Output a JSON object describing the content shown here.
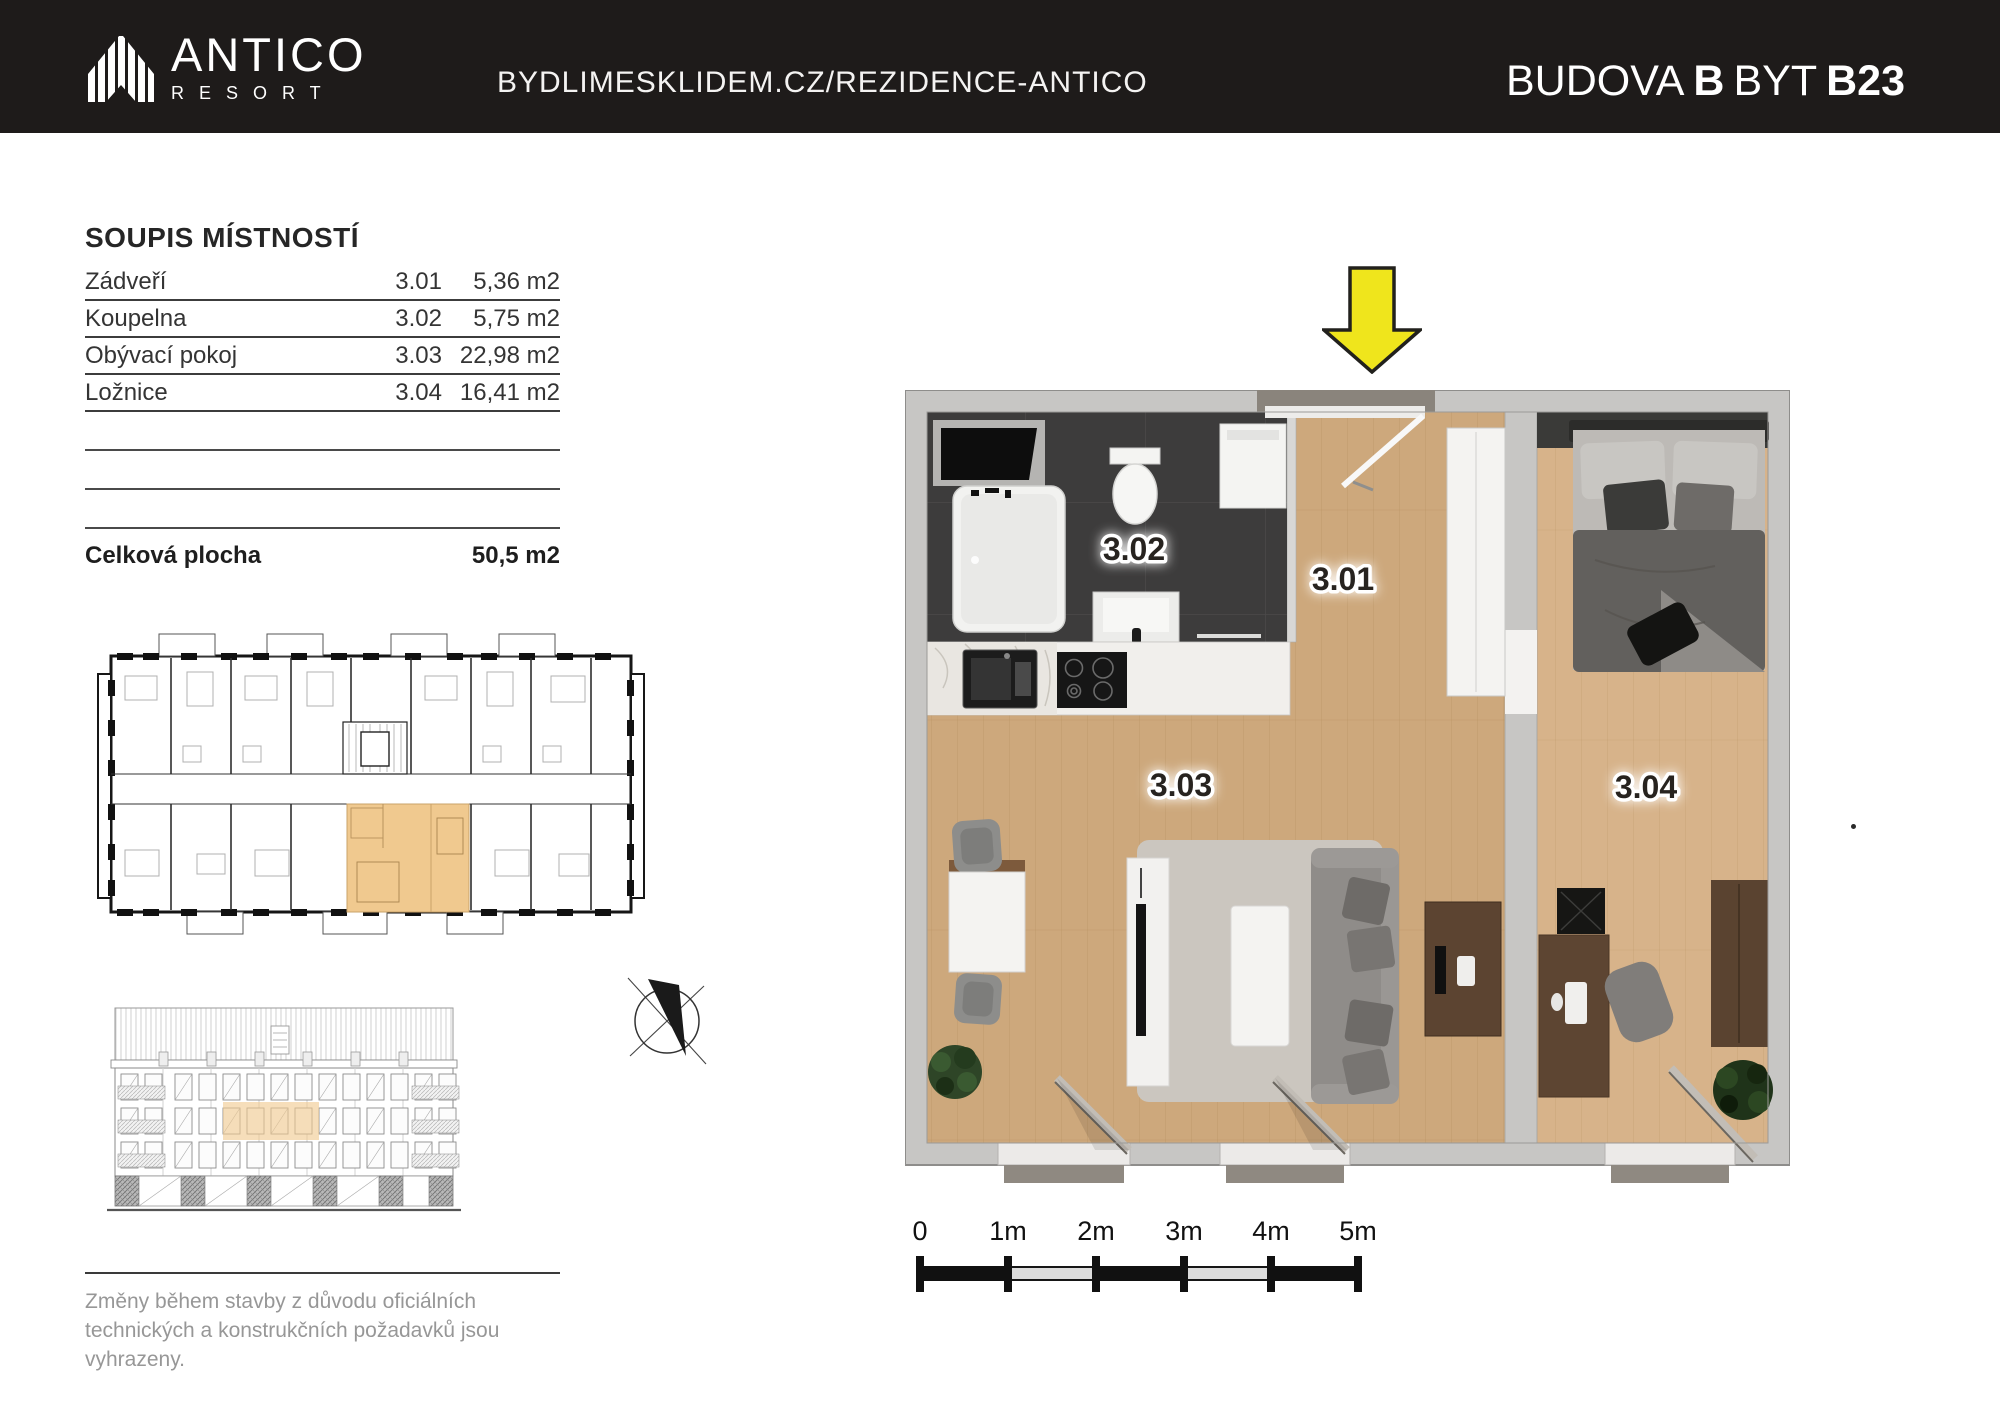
{
  "header": {
    "brand_name": "ANTICO",
    "brand_subtitle": "RESORT",
    "site_url": "BYDLIMESKLIDEM.CZ/REZIDENCE-ANTICO",
    "title": {
      "building_label": "BUDOVA",
      "building_value": "B",
      "unit_label": "BYT",
      "unit_value": "B23"
    }
  },
  "room_list": {
    "title": "SOUPIS MÍSTNOSTÍ",
    "rows": [
      {
        "name": "Zádveří",
        "number": "3.01",
        "area": "5,36 m2"
      },
      {
        "name": "Koupelna",
        "number": "3.02",
        "area": "5,75 m2"
      },
      {
        "name": "Obývací pokoj",
        "number": "3.03",
        "area": "22,98 m2"
      },
      {
        "name": "Ložnice",
        "number": "3.04",
        "area": "16,41 m2"
      }
    ],
    "total_label": "Celková plocha",
    "total_value": "50,5 m2"
  },
  "floorplan": {
    "labels": {
      "hall": "3.01",
      "bathroom": "3.02",
      "living": "3.03",
      "bedroom": "3.04"
    }
  },
  "scale_bar": {
    "labels": [
      "0",
      "1m",
      "2m",
      "3m",
      "4m",
      "5m"
    ]
  },
  "disclaimer": "Změny během stavby z důvodu oficiálních technických a konstrukčních požadavků jsou vyhrazeny.",
  "colors": {
    "header_bg": "#1e1b1a",
    "arrow_yellow": "#efe51c",
    "highlight_orange": "#f0c98f",
    "wall_gray": "#c7c6c4",
    "bathroom_dark": "#3d3c3c",
    "wood_floor": "#cda87c"
  }
}
